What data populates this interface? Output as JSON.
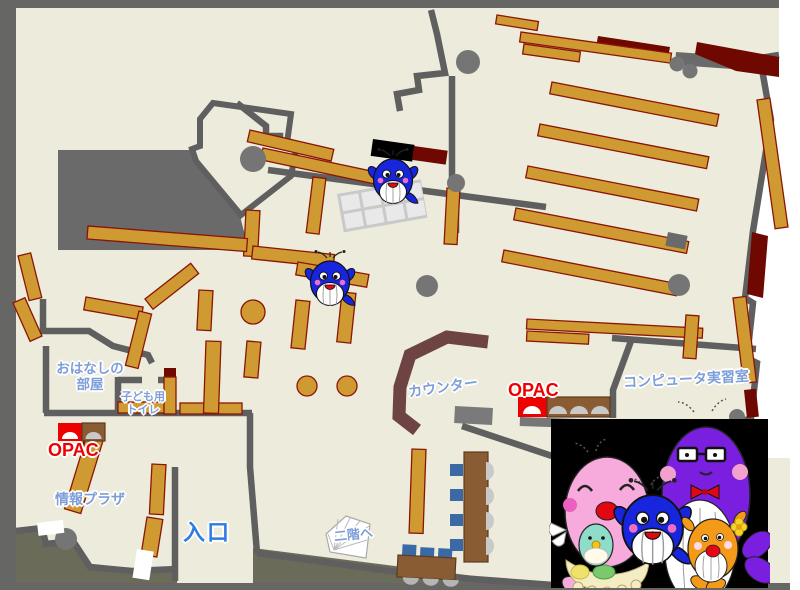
{
  "map": {
    "kind": "library-floor-map",
    "labels": {
      "storytelling_room": {
        "line1": "おはなしの",
        "line2": "部屋"
      },
      "kids_toilet": {
        "line1": "子ども用",
        "line2": "トイレ"
      },
      "opac_left": {
        "text": "OPAC"
      },
      "info_plaza": {
        "text": "情報プラザ"
      },
      "entrance": {
        "text": "入口"
      },
      "counter": {
        "text": "カウンター"
      },
      "opac_right": {
        "text": "OPAC"
      },
      "computer_room": {
        "text": "コンピュータ実習室"
      },
      "to_second_floor": {
        "text": "二階へ"
      }
    },
    "colors": {
      "floor": "#edecdc",
      "outside": "#6b6b5a",
      "frame_gray": "#666665",
      "wall_gray": "#5f5f5f",
      "shelf_tan": "#d09a33",
      "shelf_edge": "#8a1505",
      "accent_maroon": "#6e0800",
      "label_blue": "#7d9ed8",
      "entrance_blue": "#2e7ce0",
      "opac_red": "#ee0000",
      "counter_brown": "#6e4343",
      "desk_brown": "#8a5c33",
      "chair_blue": "#3b69a5",
      "photo_panel": "#000000"
    },
    "mascots": {
      "on_map": [
        "blue-whale-icon",
        "blue-whale-icon"
      ],
      "family_photo": [
        "pink-whale-icon",
        "blue-whale-icon",
        "purple-whale-icon",
        "orange-whale-icon"
      ]
    }
  }
}
